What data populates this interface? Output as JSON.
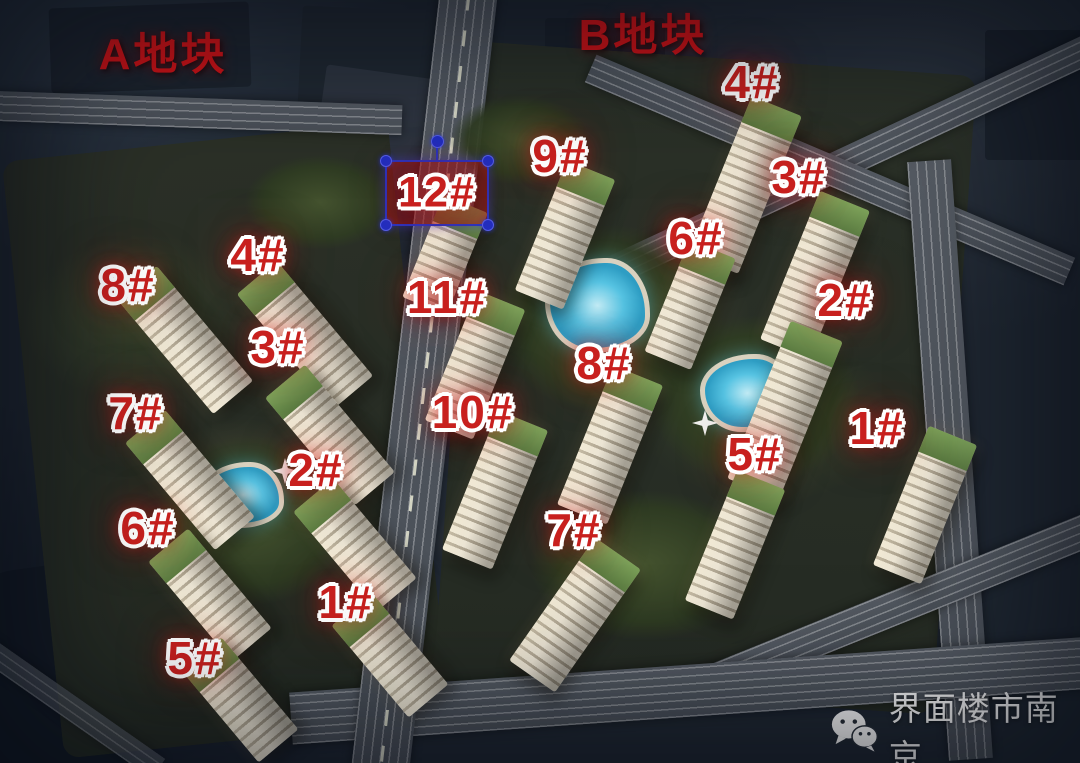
{
  "plot_labels": {
    "a": "A地块",
    "b": "B地块"
  },
  "building_labels": {
    "a8": "8#",
    "a4": "4#",
    "a3": "3#",
    "a7": "7#",
    "a2": "2#",
    "a6": "6#",
    "a1": "1#",
    "a5": "5#",
    "b12": "12#",
    "b9": "9#",
    "b11": "11#",
    "b10": "10#",
    "b4": "4#",
    "b3": "3#",
    "b6": "6#",
    "b2": "2#",
    "b8": "8#",
    "b1": "1#",
    "b5": "5#",
    "b7": "7#"
  },
  "selection": {
    "selected_building": "12#"
  },
  "watermark": {
    "account_name": "界面楼市南京",
    "icon": "wechat-icon"
  },
  "colors": {
    "label_red": "#c8201e",
    "plot_label_red": "#d21317",
    "selection_blue": "#2b36c0",
    "pool_cyan": "#56c3e2",
    "roof_green": "#6f9150",
    "road_gray": "#50565e",
    "background_navy": "#202833",
    "watermark_white": "#f3f3f3"
  }
}
